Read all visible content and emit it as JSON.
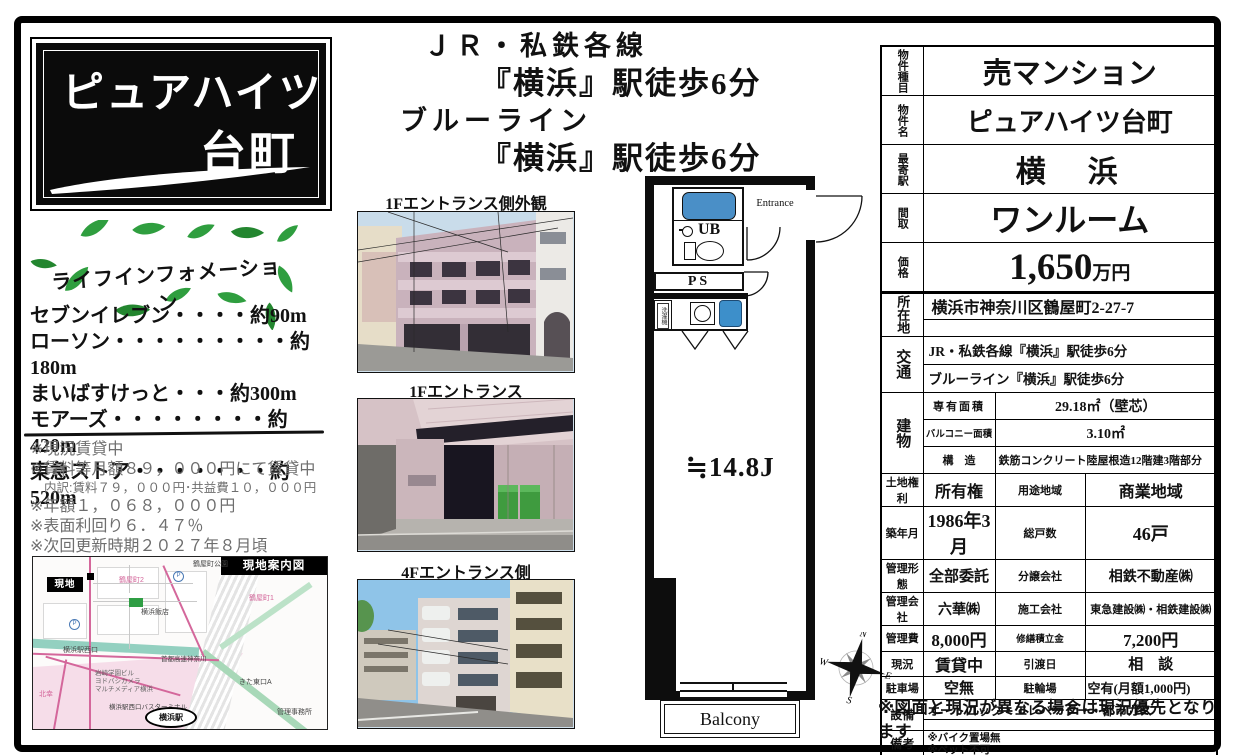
{
  "colors": {
    "bath_blue": "#4a8fc7",
    "leaf_green": "#2f9e3f",
    "map_pink_road": "#d4679b",
    "map_teal": "#93d0c0",
    "black": "#0b0b0b"
  },
  "title_box": {
    "line1": "ピュアハイツ",
    "line2": "台町"
  },
  "access": {
    "line1": "ＪＲ・私鉄各線",
    "line2": "『横浜』駅徒歩6分",
    "line3": "ブルーライン",
    "line4": "『横浜』駅徒歩6分"
  },
  "life_info": {
    "title": "ライフインフォメーション",
    "items": [
      "セブンイレブン・・・・約90m",
      "ローソン・・・・・・・・・約180m",
      "まいばすけっと・・・約300m",
      "モアーズ・・・・・・・・約420m",
      "東急ストア・・・・・・・約520m"
    ]
  },
  "notes": [
    "※現況賃貸中",
    "※賃料等月額８９，０００円にて賃貸中",
    "内訳:賃料７９，０００円･共益費１０，０００円",
    "※年額１，０６８，０００円",
    "※表面利回り６．４７％",
    "※次回更新時期２０２７年８月頃"
  ],
  "map": {
    "title": "現地案内図",
    "site_label": "現地",
    "station": "横浜駅",
    "labels": {
      "park": "鶴屋町公園",
      "town2": "鶴屋町2",
      "town1": "鶴屋町1",
      "restaurant": "横浜飯店",
      "west_exit": "横浜駅西口",
      "highway": "首都高速神奈川",
      "iwasaki": "岩崎学園ビル",
      "yodobashi": "ヨドバシカメラ",
      "multimedia": "マルチメディア横浜",
      "bus": "横浜駅西口バスターミナル",
      "kita_east": "きた東口A",
      "office": "管理事務所",
      "kitasai": "北幸"
    },
    "p_mark": "P"
  },
  "photos": [
    {
      "caption": "1Fエントランス側外観"
    },
    {
      "caption": "1Fエントランス"
    },
    {
      "caption": "4Fエントランス側"
    }
  ],
  "floor_plan": {
    "entrance": "Entrance",
    "ub": "UB",
    "ps": "PS",
    "washer": "洗濯機",
    "room_size": "≒14.8J",
    "balcony": "Balcony",
    "compass": {
      "n": "N",
      "e": "E",
      "s": "S",
      "w": "W"
    }
  },
  "summary_table": {
    "rows": [
      {
        "label": "物件種目",
        "value": "売マンション"
      },
      {
        "label": "物件名",
        "value": "ピュアハイツ台町"
      },
      {
        "label": "最寄駅",
        "value": "横　浜"
      },
      {
        "label": "間取",
        "value": "ワンルーム"
      },
      {
        "label": "価格",
        "value": "1,650",
        "unit": "万円"
      }
    ]
  },
  "detail_table": {
    "location": {
      "label": "所在地",
      "line1": "横浜市神奈川区鶴屋町2-27-7",
      "line2": ""
    },
    "access": {
      "label": "交通",
      "line1": "JR・私鉄各線『横浜』駅徒歩6分",
      "line2": "ブルーライン『横浜』駅徒歩6分"
    },
    "building": {
      "label": "建物",
      "k1": "専有面積",
      "v1": "29.18㎡（壁芯）",
      "k2": "バルコニー面積",
      "v2": "3.10㎡",
      "k3": "構　造",
      "v3": "鉄筋コンクリート陸屋根造12階建3階部分"
    },
    "grid": [
      {
        "k1": "土地権利",
        "v1": "所有権",
        "k2": "用途地域",
        "v2": "商業地域"
      },
      {
        "k1": "築年月",
        "v1": "1986年3月",
        "k2": "総戸数",
        "v2": "46戸"
      },
      {
        "k1": "管理形態",
        "v1": "全部委託",
        "k2": "分譲会社",
        "v2": "相鉄不動産㈱"
      },
      {
        "k1": "管理会社",
        "v1": "六華㈱",
        "k2": "施工会社",
        "v2": "東急建設㈱・相鉄建設㈱"
      },
      {
        "k1": "管理費",
        "v1": "8,000円",
        "k2": "修繕積立金",
        "v2": "7,200円"
      },
      {
        "k1": "現況",
        "v1": "賃貸中",
        "k2": "引渡日",
        "v2": "相　談"
      },
      {
        "k1": "駐車場",
        "v1": "空無",
        "k2": "駐輪場",
        "v2": "空有(月額1,000円)"
      }
    ],
    "equipment": {
      "label": "設備",
      "line1": "オートロック・エレベーター・都市ガス",
      "line2": ""
    },
    "remarks": {
      "label": "備考",
      "line1": "※バイク置場無",
      "line2": "※ペット不可"
    }
  },
  "footer_note": "※図面と現況が異なる場合は現況優先となります"
}
